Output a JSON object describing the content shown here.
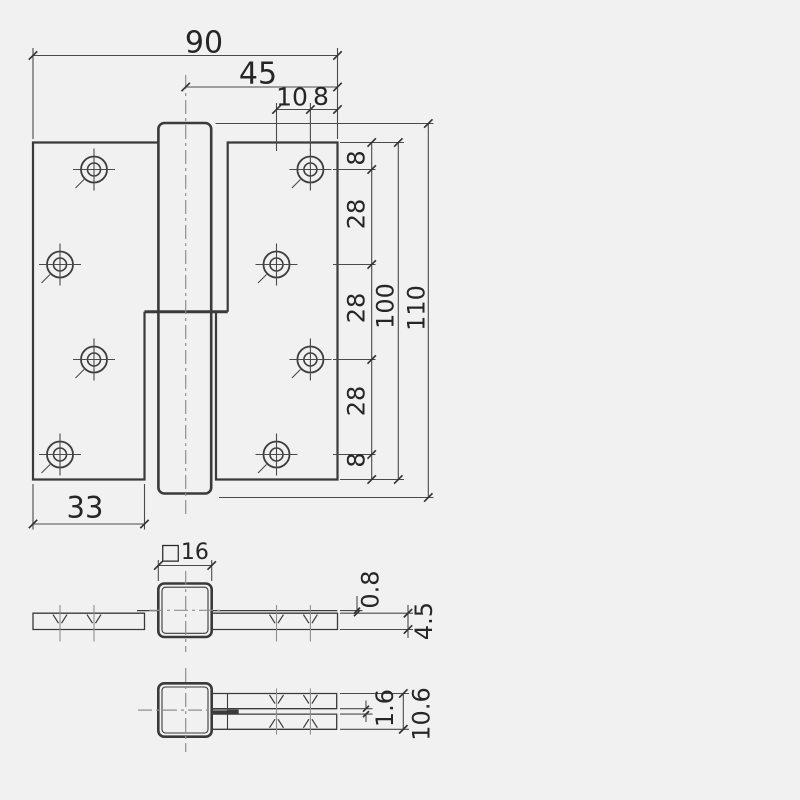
{
  "colors": {
    "background": "#f1f1f2",
    "line": "#3a3a3a",
    "dimension_line": "#4a4a4a",
    "centerline": "#8f8f8f",
    "text": "#262626"
  },
  "drawing": {
    "type": "technical-drawing",
    "subject": "lift-off door hinge, three orthographic views",
    "front_view": {
      "overall_width": "90",
      "center_to_edge": "45",
      "hole_column_offset": "10",
      "hole_edge_offset": "8",
      "hole_pitches": [
        "8",
        "28",
        "28",
        "28",
        "8"
      ],
      "leaf_height": "100",
      "overall_height": "110",
      "leaf_width": "33"
    },
    "top_view_open": {
      "knuckle_square": "□16",
      "surface_step": "0.8",
      "leaf_thickness": "4.5"
    },
    "top_view_folded": {
      "leaf_gap": "1.6",
      "folded_thickness": "10.6"
    }
  }
}
